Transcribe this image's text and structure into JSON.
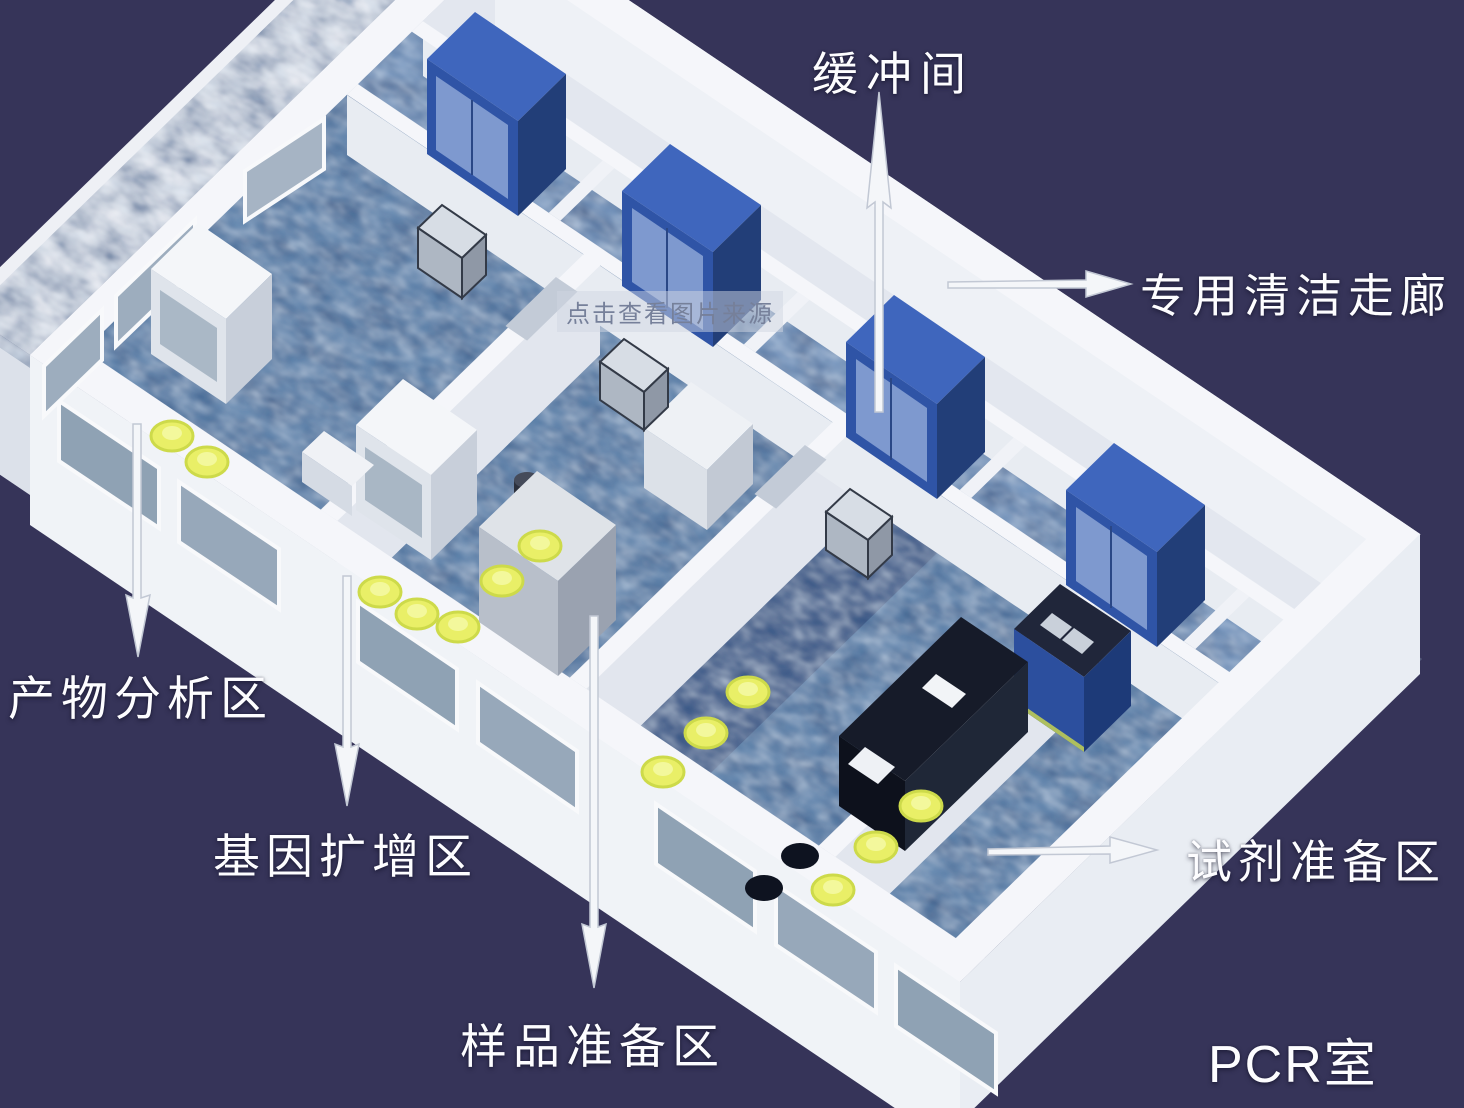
{
  "labels": {
    "buffer_room": "缓冲间",
    "clean_corridor": "专用清洁走廊",
    "product_analysis": "产物分析区",
    "gene_amplification": "基因扩增区",
    "sample_preparation": "样品准备区",
    "reagent_preparation": "试剂准备区",
    "pcr_room": "PCR室"
  },
  "watermark": "点击查看图片来源",
  "colors": {
    "background": "#363459",
    "wall": "#f2f4f8",
    "room_floor": "#6488b0",
    "corridor_floor": "#e3e7ef",
    "cabinet_blue": "#3558a8",
    "stool_yellow": "#e9ef67",
    "bench_dark": "#141824",
    "label_text": "#ffffff"
  }
}
